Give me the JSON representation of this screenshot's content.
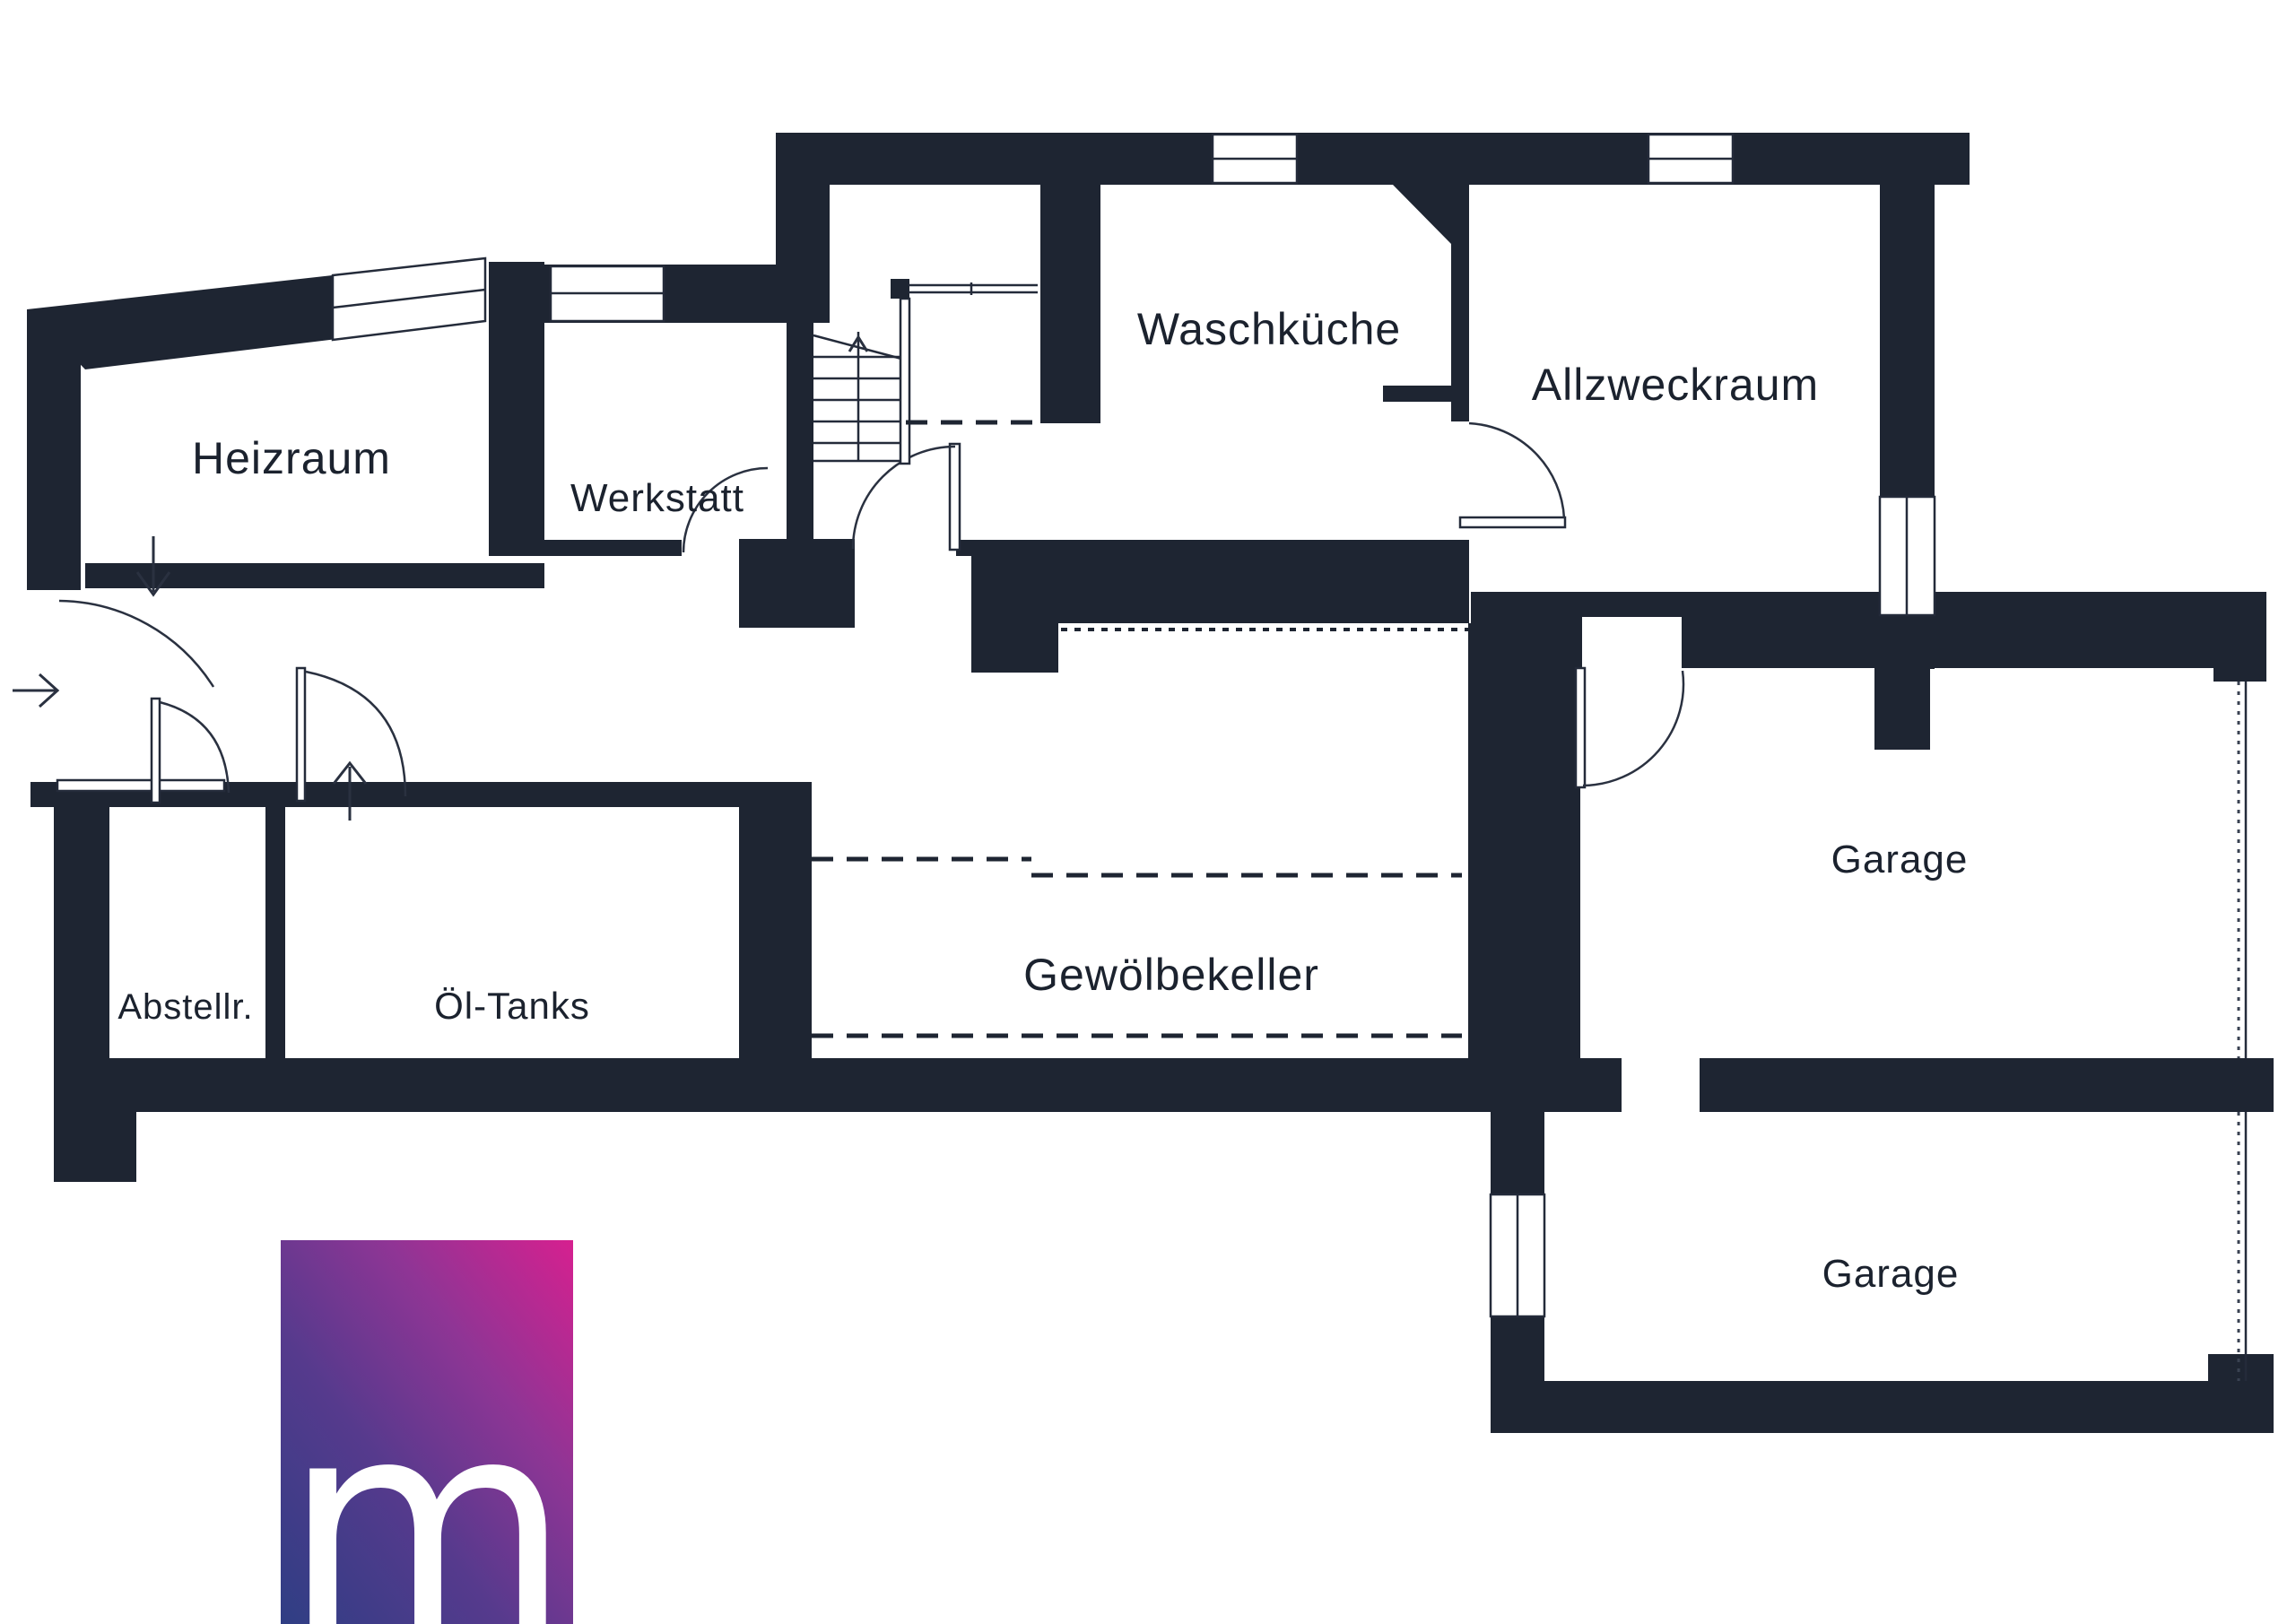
{
  "floorplan": {
    "rooms": [
      {
        "name": "Heizraum"
      },
      {
        "name": "Werkstatt"
      },
      {
        "name": "Waschküche"
      },
      {
        "name": "Allzweckraum"
      },
      {
        "name": "Abstellr."
      },
      {
        "name": "Öl-Tanks"
      },
      {
        "name": "Gewölbekeller"
      },
      {
        "name": "Garage"
      },
      {
        "name": "Garage"
      }
    ],
    "icons": [
      {
        "id": "entry-arrow-icon",
        "meaning": "entrance direction arrow"
      },
      {
        "id": "down-arrow-icon",
        "meaning": "door direction arrow Heizraum"
      },
      {
        "id": "up-arrow-icon",
        "meaning": "door direction arrow Öl-Tanks"
      },
      {
        "id": "stair-up-arrow-icon",
        "meaning": "stair direction arrow"
      }
    ],
    "colors": {
      "wall": "#1e2532",
      "background": "#ffffff",
      "logo_gradient_top_right": "#d6208f",
      "logo_gradient_mid": "#8f3595",
      "logo_gradient_bottom_left": "#2f3e84"
    },
    "logo": {
      "letter": "m"
    }
  }
}
